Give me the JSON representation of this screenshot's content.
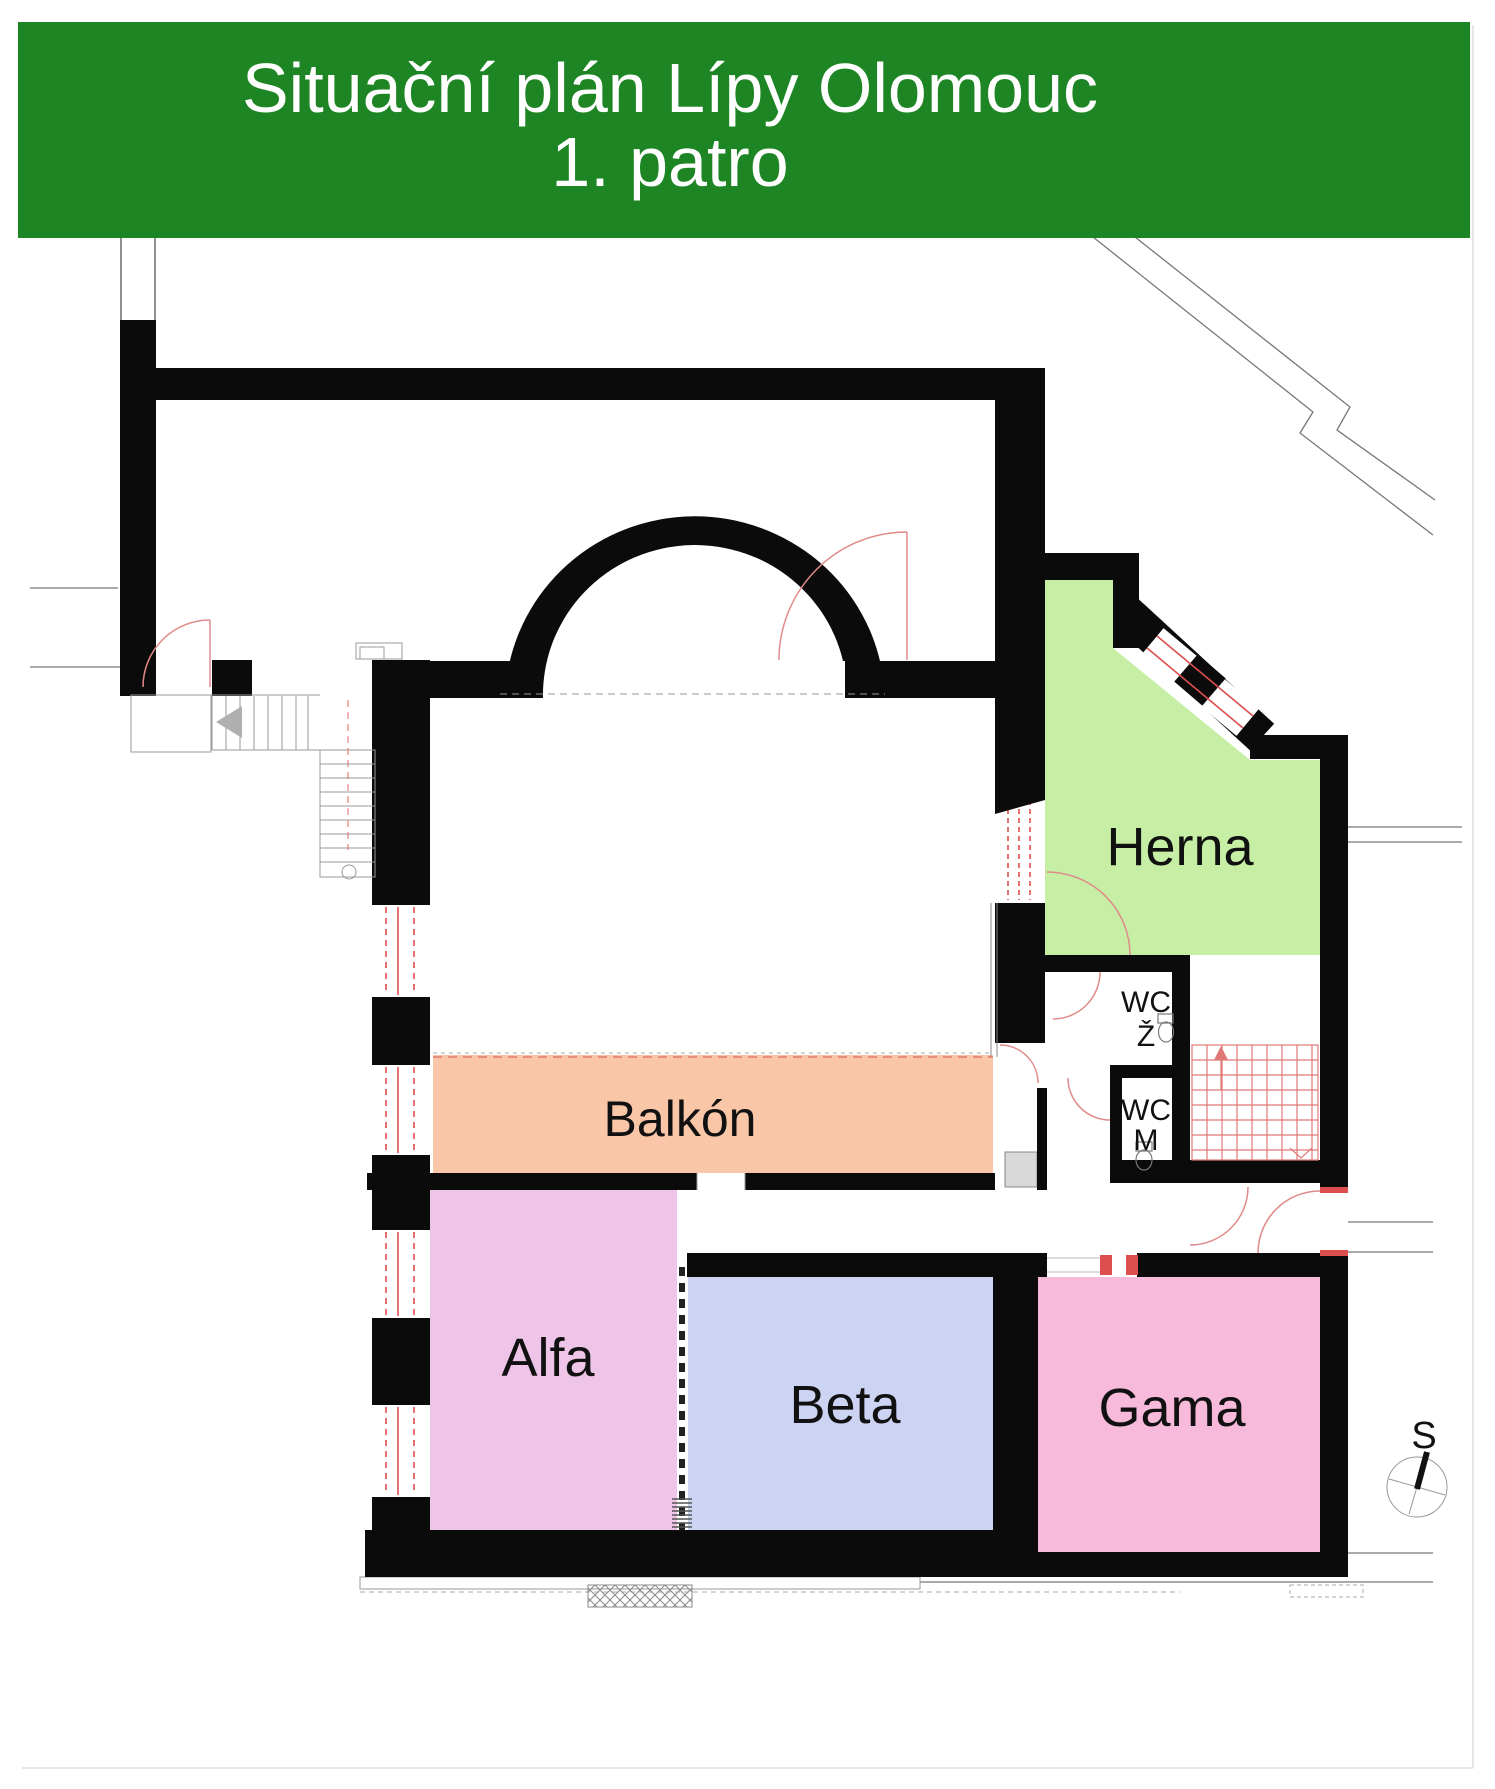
{
  "banner": {
    "title_line1": "Situační plán Lípy Olomouc",
    "title_line2": "1. patro",
    "bg": "#1d8523",
    "text_color": "#ffffff"
  },
  "rooms": {
    "herna": {
      "label": "Herna",
      "color": "#c6efa5"
    },
    "balkon": {
      "label": "Balkón",
      "color": "#f9c7a7"
    },
    "alfa": {
      "label": "Alfa",
      "color": "#eec5e9"
    },
    "beta": {
      "label": "Beta",
      "color": "#ccd3f3"
    },
    "gama": {
      "label": "Gama",
      "color": "#f8bada"
    }
  },
  "wc": {
    "women_line1": "WC",
    "women_line2": "Ž",
    "men_line1": "WC",
    "men_line2": "M"
  },
  "compass": {
    "label": "S"
  },
  "palette": {
    "wall": "#0b0b0b",
    "detail_red": "#e06a6a",
    "window_red": "#dd4f4f",
    "context_gray": "#777777",
    "light_gray": "#999999",
    "shaft_gray": "#d9d9d9",
    "label_color": "#111111"
  }
}
